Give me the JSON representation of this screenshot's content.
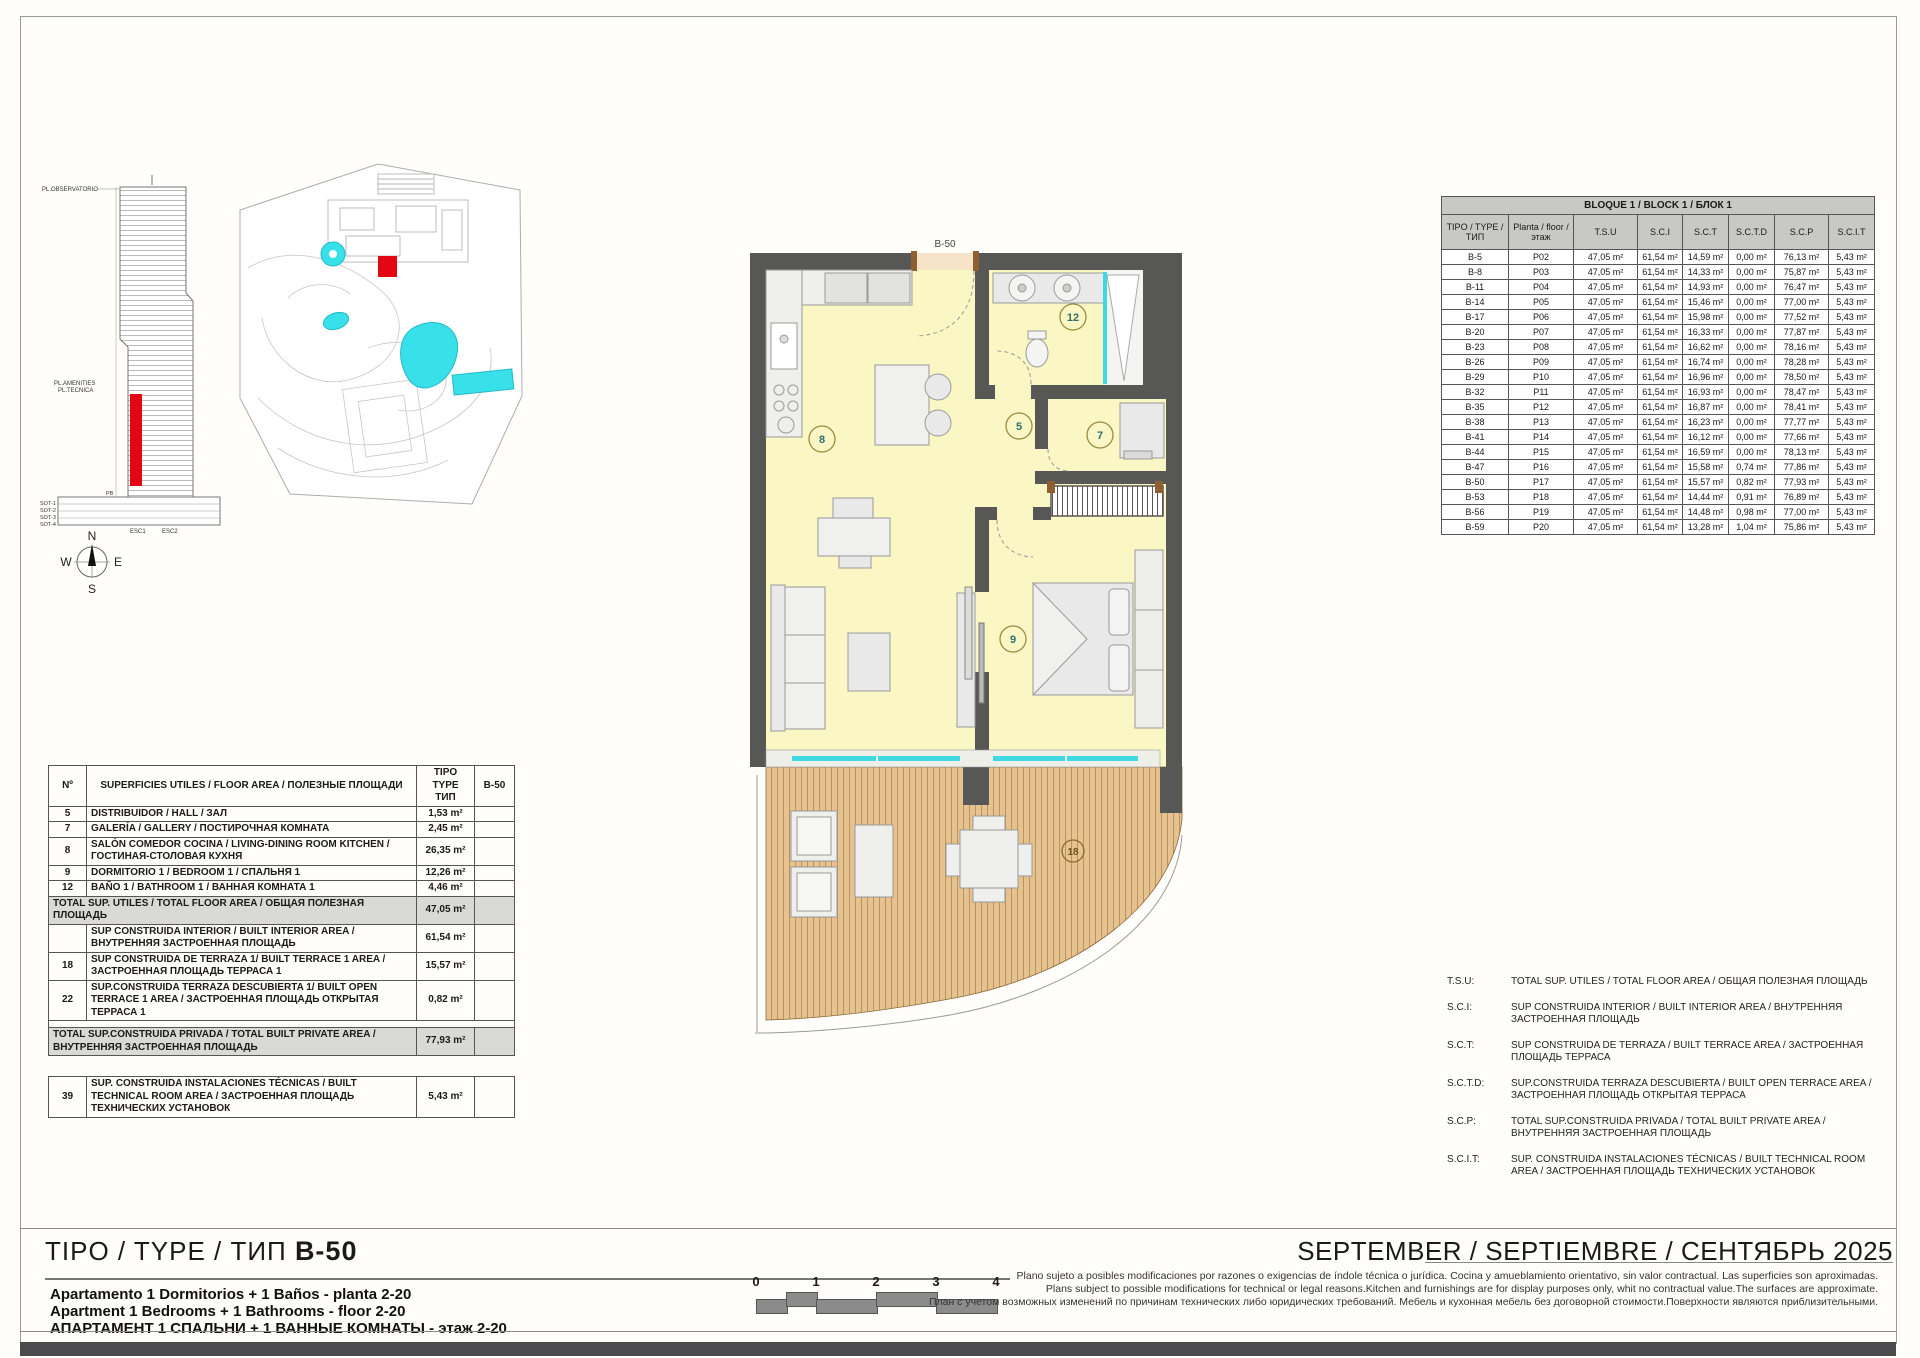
{
  "colors": {
    "accent_red": "#E30613",
    "pool_cyan": "#38E0EA",
    "wall": "#575756",
    "room_yellow": "#FBF7C5",
    "wood": "#E6C290",
    "table_header_gray": "#C8C8C6",
    "total_row_gray": "#D9D9D6"
  },
  "elevation": {
    "labels": {
      "observatorio": "PL.OBSERVATORIO",
      "amenities": "PL.AMENITIES",
      "tecnica": "PL.TECNICA",
      "pb": "PB",
      "sot1": "SOT-1",
      "sot2": "SOT-2",
      "sot3": "SOT-3",
      "sot4": "SOT-4",
      "esc1": "ESC1",
      "esc2": "ESC2"
    }
  },
  "compass": {
    "n": "N",
    "s": "S",
    "e": "E",
    "w": "W"
  },
  "floor_plan": {
    "unit_label": "B-50",
    "rooms": {
      "living": "8",
      "hall": "5",
      "gallery": "7",
      "bath": "12",
      "bedroom": "9",
      "terrace": "18"
    }
  },
  "bloque_table": {
    "title": "BLOQUE 1 / BLOCK 1 / БЛОК 1",
    "columns": [
      "TIPO / TYPE / ТИП",
      "Planta / floor / этаж",
      "T.S.U",
      "S.C.I",
      "S.C.T",
      "S.C.T.D",
      "S.C.P",
      "S.C.I.T"
    ],
    "rows": [
      [
        "B-5",
        "P02",
        "47,05 m²",
        "61,54 m²",
        "14,59 m²",
        "0,00 m²",
        "76,13 m²",
        "5,43 m²"
      ],
      [
        "B-8",
        "P03",
        "47,05 m²",
        "61,54 m²",
        "14,33 m²",
        "0,00 m²",
        "75,87 m²",
        "5,43 m²"
      ],
      [
        "B-11",
        "P04",
        "47,05 m²",
        "61,54 m²",
        "14,93 m²",
        "0,00 m²",
        "76,47 m²",
        "5,43 m²"
      ],
      [
        "B-14",
        "P05",
        "47,05 m²",
        "61,54 m²",
        "15,46 m²",
        "0,00 m²",
        "77,00 m²",
        "5,43 m²"
      ],
      [
        "B-17",
        "P06",
        "47,05 m²",
        "61,54 m²",
        "15,98 m²",
        "0,00 m²",
        "77,52 m²",
        "5,43 m²"
      ],
      [
        "B-20",
        "P07",
        "47,05 m²",
        "61,54 m²",
        "16,33 m²",
        "0,00 m²",
        "77,87 m²",
        "5,43 m²"
      ],
      [
        "B-23",
        "P08",
        "47,05 m²",
        "61,54 m²",
        "16,62 m²",
        "0,00 m²",
        "78,16 m²",
        "5,43 m²"
      ],
      [
        "B-26",
        "P09",
        "47,05 m²",
        "61,54 m²",
        "16,74 m²",
        "0,00 m²",
        "78,28 m²",
        "5,43 m²"
      ],
      [
        "B-29",
        "P10",
        "47,05 m²",
        "61,54 m²",
        "16,96 m²",
        "0,00 m²",
        "78,50 m²",
        "5,43 m²"
      ],
      [
        "B-32",
        "P11",
        "47,05 m²",
        "61,54 m²",
        "16,93 m²",
        "0,00 m²",
        "78,47 m²",
        "5,43 m²"
      ],
      [
        "B-35",
        "P12",
        "47,05 m²",
        "61,54 m²",
        "16,87 m²",
        "0,00 m²",
        "78,41 m²",
        "5,43 m²"
      ],
      [
        "B-38",
        "P13",
        "47,05 m²",
        "61,54 m²",
        "16,23 m²",
        "0,00 m²",
        "77,77 m²",
        "5,43 m²"
      ],
      [
        "B-41",
        "P14",
        "47,05 m²",
        "61,54 m²",
        "16,12 m²",
        "0,00 m²",
        "77,66 m²",
        "5,43 m²"
      ],
      [
        "B-44",
        "P15",
        "47,05 m²",
        "61,54 m²",
        "16,59 m²",
        "0,00 m²",
        "78,13 m²",
        "5,43 m²"
      ],
      [
        "B-47",
        "P16",
        "47,05 m²",
        "61,54 m²",
        "15,58 m²",
        "0,74 m²",
        "77,86 m²",
        "5,43 m²"
      ],
      [
        "B-50",
        "P17",
        "47,05 m²",
        "61,54 m²",
        "15,57 m²",
        "0,82 m²",
        "77,93 m²",
        "5,43 m²"
      ],
      [
        "B-53",
        "P18",
        "47,05 m²",
        "61,54 m²",
        "14,44 m²",
        "0,91 m²",
        "76,89 m²",
        "5,43 m²"
      ],
      [
        "B-56",
        "P19",
        "47,05 m²",
        "61,54 m²",
        "14,48 m²",
        "0,98 m²",
        "77,00 m²",
        "5,43 m²"
      ],
      [
        "B-59",
        "P20",
        "47,05 m²",
        "61,54 m²",
        "13,28 m²",
        "1,04 m²",
        "75,86 m²",
        "5,43 m²"
      ]
    ]
  },
  "area_table": {
    "headers": {
      "no": "Nº",
      "desc": "SUPERFICIES UTILES / FLOOR AREA / ПОЛЕЗНЫЕ ПЛОЩАДИ",
      "tipo": "TIPO TYPE ТИП",
      "code": "B-50"
    },
    "rows": [
      {
        "kind": "normal",
        "no": "5",
        "desc": "DISTRIBUIDOR /  HALL / ЗАЛ",
        "value": "1,53 m²"
      },
      {
        "kind": "normal",
        "no": "7",
        "desc": "GALERÍA / GALLERY / ПОСТИРОЧНАЯ КОМНАТА",
        "value": "2,45 m²"
      },
      {
        "kind": "normal",
        "no": "8",
        "desc": "SALÓN COMEDOR COCINA  / LIVING-DINING ROOM KITCHEN / ГОСТИНАЯ-СТОЛОВАЯ КУХНЯ",
        "value": "26,35 m²"
      },
      {
        "kind": "normal",
        "no": "9",
        "desc": "DORMITORIO 1 / BEDROOM 1 / СПАЛЬНЯ 1",
        "value": "12,26 m²"
      },
      {
        "kind": "normal",
        "no": "12",
        "desc": "BAÑO 1 / BATHROOM 1 / ВАННАЯ КОМНАТА 1",
        "value": "4,46 m²"
      },
      {
        "kind": "total",
        "desc": "TOTAL SUP. UTILES / TOTAL FLOOR AREA / ОБЩАЯ ПОЛЕЗНАЯ ПЛОЩАДЬ",
        "value": "47,05 m²"
      },
      {
        "kind": "normal",
        "no": "",
        "desc": "SUP CONSTRUIDA INTERIOR / BUILT INTERIOR AREA / ВНУТРЕННЯЯ ЗАСТРОЕННАЯ  ПЛОЩАДЬ",
        "value": "61,54 m²"
      },
      {
        "kind": "normal",
        "no": "18",
        "desc": "SUP CONSTRUIDA  DE TERRAZA 1/ BUILT TERRACE 1 AREA / ЗАСТРОЕННАЯ ПЛОЩАДЬ ТЕРРАСА 1",
        "value": "15,57 m²"
      },
      {
        "kind": "normal",
        "no": "22",
        "desc": "SUP.CONSTRUIDA TERRAZA DESCUBIERTA 1/ BUILT OPEN TERRACE 1 AREA /  ЗАСТРОЕННАЯ ПЛОЩАДЬ ОТКРЫТАЯ ТЕРРАСА  1",
        "value": "0,82 m²"
      },
      {
        "kind": "spacer"
      },
      {
        "kind": "total",
        "desc": "TOTAL SUP.CONSTRUIDA PRIVADA / TOTAL  BUILT PRIVATE AREA / ВНУТРЕННЯЯ ЗАСТРОЕННАЯ ПЛОЩАДЬ",
        "value": "77,93 m²"
      }
    ],
    "technical": {
      "no": "39",
      "desc": "SUP. CONSTRUIDA INSTALACIONES TÉCNICAS / BUILT TECHNICAL ROOM AREA / ЗАСТРОЕННАЯ ПЛОЩАДЬ ТЕХНИЧЕСКИХ УСТАНОВОК",
      "value": "5,43 m²"
    }
  },
  "legend": {
    "items": [
      {
        "abbr": "T.S.U:",
        "text": "TOTAL SUP. UTILES / TOTAL FLOOR AREA / ОБЩАЯ ПОЛЕЗНАЯ ПЛОЩАДЬ"
      },
      {
        "abbr": "S.C.I:",
        "text": "SUP CONSTRUIDA INTERIOR / BUILT INTERIOR AREA / ВНУТРЕННЯЯ ЗАСТРОЕННАЯ ПЛОЩАДЬ"
      },
      {
        "abbr": "S.C.T:",
        "text": "SUP CONSTRUIDA DE TERRAZA / BUILT TERRACE AREA / ЗАСТРОЕННАЯ ПЛОЩАДЬ ТЕРРАСА"
      },
      {
        "abbr": "S.C.T.D:",
        "text": "SUP.CONSTRUIDA TERRAZA DESCUBIERTA / BUILT OPEN TERRACE AREA / ЗАСТРОЕННАЯ ПЛОЩАДЬ ОТКРЫТАЯ ТЕРРАСА"
      },
      {
        "abbr": "S.C.P:",
        "text": "TOTAL SUP.CONSTRUIDA PRIVADA / TOTAL BUILT PRIVATE AREA / ВНУТРЕННЯЯ ЗАСТРОЕННАЯ ПЛОЩАДЬ"
      },
      {
        "abbr": "S.C.I.T:",
        "text": "SUP. CONSTRUIDA INSTALACIONES TÉCNICAS / BUILT TECHNICAL ROOM AREA / ЗАСТРОЕННАЯ ПЛОЩАДЬ ТЕХНИЧЕСКИХ УСТАНОВОК"
      }
    ]
  },
  "footer": {
    "type_title": "TIPO / TYPE  / ТИП ",
    "type_code": "B-50",
    "subtitle_es": "Apartamento 1 Dormitorios + 1 Baños - planta 2-20",
    "subtitle_en": "Apartment 1 Bedrooms + 1 Bathrooms - floor 2-20",
    "subtitle_ru": "АПАРТАМЕНТ 1 СПАЛЬНИ + 1 ВАННЫЕ КОМНАТЫ - этаж 2-20",
    "scale_ticks": [
      "0",
      "1",
      "2",
      "3",
      "4"
    ],
    "disclaimer_es": "Plano sujeto a posibles modificaciones por razones o exigencias de índole técnica o jurídica. Cocina y amueblamiento orientativo, sin valor contractual. Las superficies son aproximadas.",
    "disclaimer_en": "Plans subject to possible modifications for technical or legal reasons.Kitchen and furnishings are for display purposes only, whit no contractual value.The surfaces are approximate.",
    "disclaimer_ru": "План с учетом возможных изменений по причинам технических либо юридических требований. Мебель и кухонная мебель без договорной стоимости.Поверхности являются приблизительными.",
    "date": "SEPTEMBER / SEPTIEMBRE / СЕНТЯБРЬ 2025"
  }
}
